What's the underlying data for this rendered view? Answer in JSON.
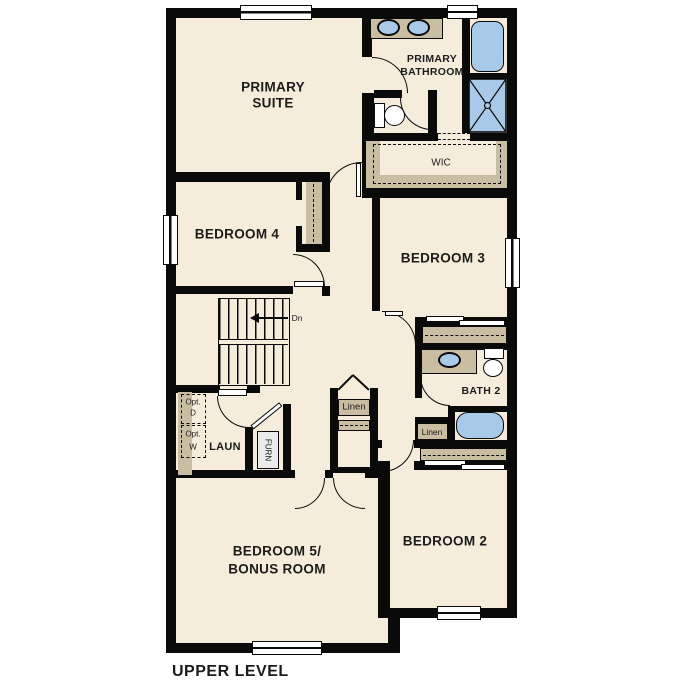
{
  "plan_title": "UPPER LEVEL",
  "colors": {
    "wall": "#0a0a0a",
    "floor": "#f5ecdc",
    "casework_tan": "#c9bda2",
    "fixture_blue": "#a9c9e9",
    "background": "#ffffff"
  },
  "labels": {
    "primary_suite_line1": "PRIMARY",
    "primary_suite_line2": "SUITE",
    "primary_bathroom_line1": "PRIMARY",
    "primary_bathroom_line2": "BATHROOM",
    "wic": "WIC",
    "bedroom4": "BEDROOM 4",
    "bedroom3": "BEDROOM 3",
    "bath2": "BATH 2",
    "laundry": "LAUN",
    "furnace": "FURN",
    "linen_hall": "Linen",
    "linen_bath": "Linen",
    "opt_dryer_line1": "Opt.",
    "opt_dryer_line2": "D",
    "opt_washer_line1": "Opt.",
    "opt_washer_line2": "W",
    "stairs_direction": "Dn",
    "bedroom5_line1": "BEDROOM 5/",
    "bedroom5_line2": "BONUS ROOM",
    "bedroom2": "BEDROOM 2",
    "title": "UPPER LEVEL"
  }
}
